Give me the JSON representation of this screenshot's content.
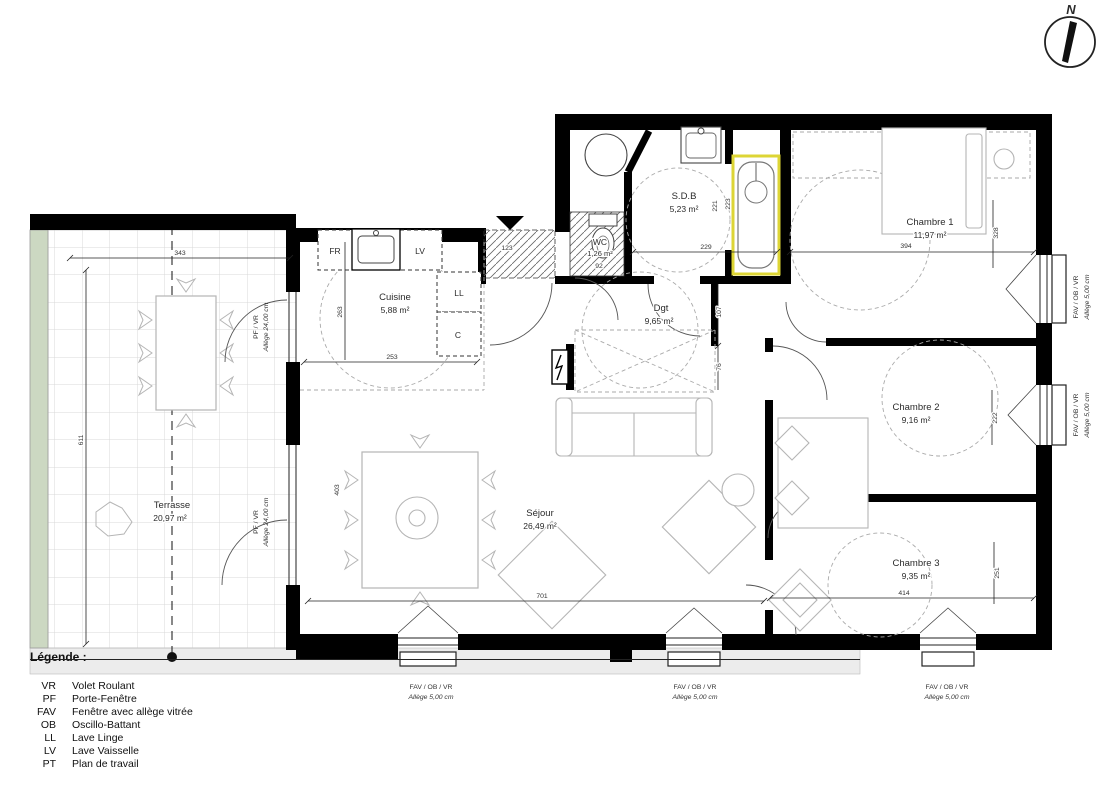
{
  "north": {
    "label": "N"
  },
  "legend": {
    "title": "Légende :",
    "items": [
      {
        "abbr": "VR",
        "label": "Volet Roulant"
      },
      {
        "abbr": "PF",
        "label": "Porte-Fenêtre"
      },
      {
        "abbr": "FAV",
        "label": "Fenêtre avec allège vitrée"
      },
      {
        "abbr": "OB",
        "label": "Oscillo-Battant"
      },
      {
        "abbr": "LL",
        "label": "Lave Linge"
      },
      {
        "abbr": "LV",
        "label": "Lave Vaisselle"
      },
      {
        "abbr": "PT",
        "label": "Plan de travail"
      }
    ]
  },
  "rooms": {
    "terrasse": {
      "name": "Terrasse",
      "area": "20,97 m²"
    },
    "cuisine": {
      "name": "Cuisine",
      "area": "5,88 m²"
    },
    "sejour": {
      "name": "Séjour",
      "area": "26,49 m²"
    },
    "wc": {
      "name": "WC",
      "area": "1,26 m²"
    },
    "sdb": {
      "name": "S.D.B",
      "area": "5,23 m²"
    },
    "dgt": {
      "name": "Dgt",
      "area": "9,65 m²"
    },
    "chambre1": {
      "name": "Chambre 1",
      "area": "11,97 m²"
    },
    "chambre2": {
      "name": "Chambre 2",
      "area": "9,16 m²"
    },
    "chambre3": {
      "name": "Chambre 3",
      "area": "9,35 m²"
    }
  },
  "appliances": {
    "fridge": "FR",
    "dishwasher": "LV",
    "washer": "LL",
    "closet": "C"
  },
  "dims": {
    "terrasse_width": "343",
    "terrasse_depth": "611",
    "cuisine_width": "253",
    "cuisine_depth": "263",
    "entry_width": "123",
    "wc_width": "92",
    "sdb_width": "229",
    "sdb_depth_a": "221",
    "sdb_depth_b": "223",
    "chambre1_width": "394",
    "chambre1_depth": "328",
    "dgt_a": "107",
    "dgt_b": "76",
    "sejour_width": "701",
    "sejour_depth": "403",
    "chambre2_depth": "222",
    "chambre3_width": "414",
    "chambre3_depth": "251"
  },
  "windows": {
    "pf_line1": "PF / VR",
    "pf_line2": "Allège  24,00 cm",
    "fav_line1": "FAV / OB / VR",
    "fav_line2": "Allège  5,00 cm"
  },
  "colors": {
    "bath_highlight": "#ddd535",
    "terrace_planter": "#ccd8c2",
    "north_n": "#1f3864"
  }
}
